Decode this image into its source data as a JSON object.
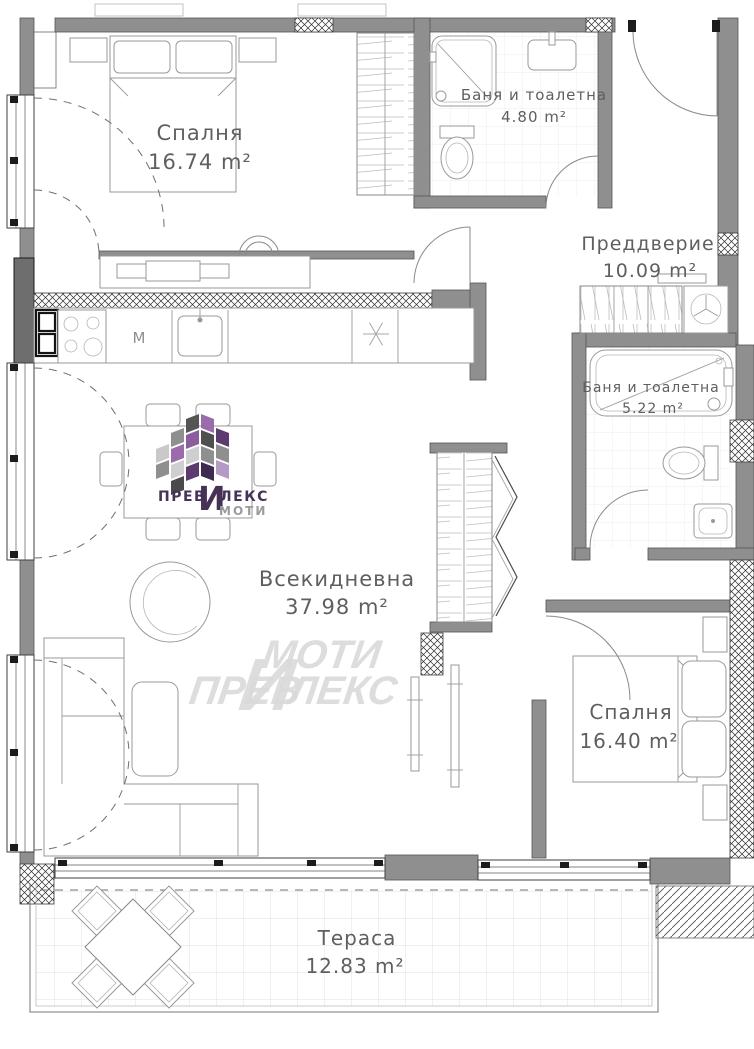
{
  "rooms": [
    {
      "id": "bedroom-1",
      "name": "Спалня",
      "area": "16.74 m²"
    },
    {
      "id": "bathroom-1",
      "name": "Баня и тоалетна",
      "area": "4.80 m²"
    },
    {
      "id": "vestibule",
      "name": "Преддверие",
      "area": "10.09 m²"
    },
    {
      "id": "bathroom-2",
      "name": "Баня и тоалетна",
      "area": "5.22 m²"
    },
    {
      "id": "living-room",
      "name": "Всекидневна",
      "area": "37.98 m²"
    },
    {
      "id": "bedroom-2",
      "name": "Спалня",
      "area": "16.40 m²"
    },
    {
      "id": "terrace",
      "name": "Тераса",
      "area": "12.83 m²"
    }
  ],
  "kitchen": {
    "appliance_label": "М"
  },
  "brand": {
    "logo": {
      "prefix": "ПРЕВ",
      "big_letter": "И",
      "suffix": "ЛЕКС",
      "line2": "МОТИ"
    },
    "watermark": {
      "top": "МОТИ",
      "big_letter": "И",
      "left": "ПРЕВ",
      "bottom": "ЛЕКС"
    },
    "colors": {
      "purple_dark": "#3f2b4f",
      "purple": "#5d3b6e",
      "purple_light": "#9b6bab",
      "lilac": "#b49ac4",
      "gray_dark": "#4f4f4f",
      "gray": "#8f8f8f",
      "gray_light": "#cfcfcf",
      "text_purple": "#463257",
      "text_gray": "#9b9b9b",
      "watermark_gray": "#d9d9d9"
    }
  },
  "colors": {
    "wall": "#8f8f8f",
    "wall_dark": "#6e6e6e",
    "label_text": "#5f5f5f"
  }
}
